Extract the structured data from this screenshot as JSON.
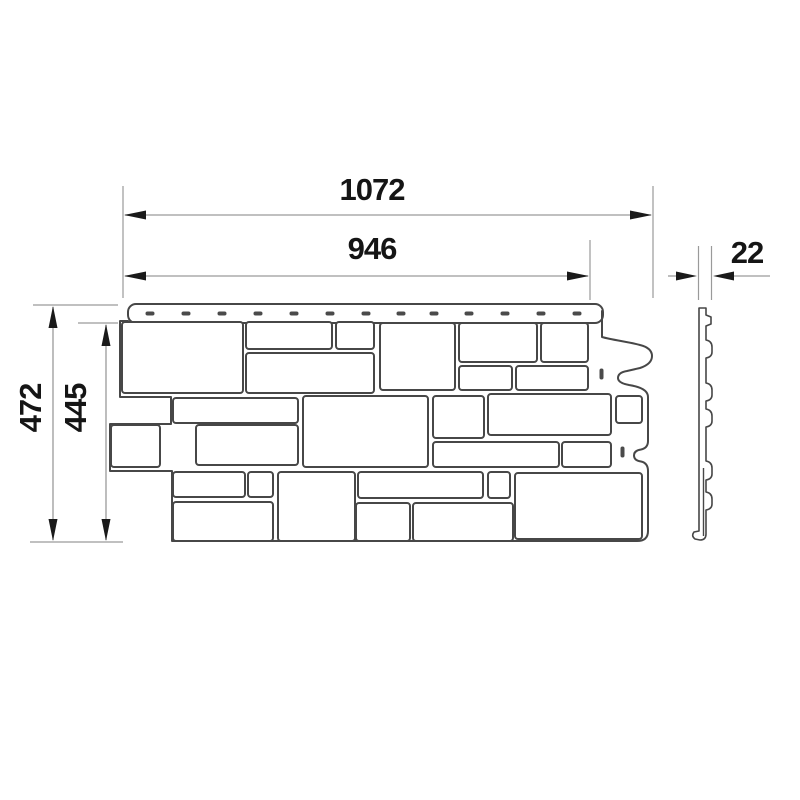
{
  "drawing": {
    "type": "technical-dimension-drawing",
    "subject": "stone-effect facade cladding panel",
    "dimensions": {
      "overall_width": "1072",
      "exposed_width": "946",
      "thickness": "22",
      "overall_height": "472",
      "exposed_height": "445"
    },
    "colors": {
      "background": "#ffffff",
      "outline": "#474747",
      "dimension_line": "#9a9a9a",
      "text": "#151515"
    }
  }
}
